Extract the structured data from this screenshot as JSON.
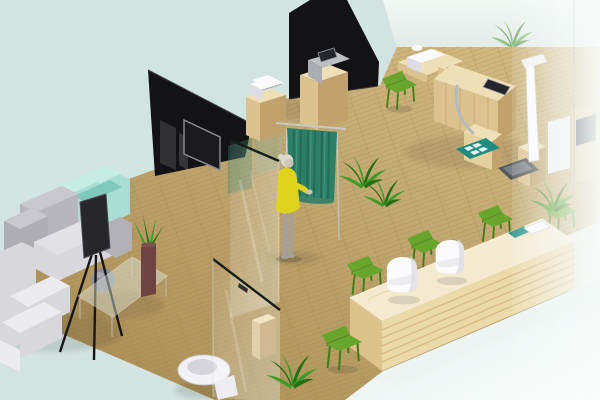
{
  "scene": {
    "type": "isometric-3d-interior-render",
    "setting": "clinic office floor plan 3D rendering",
    "areas": [
      {
        "id": "waiting-area",
        "label": "waiting area with gray corner sofa and mint armchair"
      },
      {
        "id": "consultation-room",
        "label": "consultation room with teal privacy curtain and standing woman"
      },
      {
        "id": "exam-room",
        "label": "exam room with wooden workstation, devices and height scale"
      },
      {
        "id": "reception",
        "label": "reception with long wooden counter and green chairs"
      },
      {
        "id": "restroom",
        "label": "restroom with toilet behind glass partition"
      }
    ],
    "objects": [
      {
        "id": "dark-wall-panel-left",
        "label": "black wall panel with mounted TV"
      },
      {
        "id": "dark-wall-panel-top",
        "label": "black wall panel wedge"
      },
      {
        "id": "privacy-curtain",
        "label": "teal privacy curtain on rail"
      },
      {
        "id": "woman-figure",
        "label": "woman in yellow dress"
      },
      {
        "id": "gray-sofa",
        "label": "gray L-shaped sofa"
      },
      {
        "id": "mint-armchair",
        "label": "mint armchair"
      },
      {
        "id": "tv-tripod",
        "label": "TV display on tripod stand"
      },
      {
        "id": "coffee-table",
        "label": "glass coffee table with plant vase"
      },
      {
        "id": "printer-cabinets",
        "label": "wood cabinets with printer and monitor devices"
      },
      {
        "id": "exam-workstation",
        "label": "wooden exam workstation with embedded screen"
      },
      {
        "id": "height-scale",
        "label": "white height and weight scale"
      },
      {
        "id": "teal-floor-mat",
        "label": "teal floor mat"
      },
      {
        "id": "reception-counter",
        "label": "long light-wood reception counter"
      },
      {
        "id": "green-chairs",
        "label": "apple-green side chairs"
      },
      {
        "id": "white-chairs",
        "label": "white molded chairs"
      },
      {
        "id": "toilet",
        "label": "white toilet"
      },
      {
        "id": "glass-partitions",
        "label": "glass partition walls"
      },
      {
        "id": "frosted-glass-wall",
        "label": "frosted glass wall on the right"
      },
      {
        "id": "potted-plants",
        "label": "green potted plants"
      }
    ]
  },
  "colors": {
    "background": "#d2e4e1",
    "floor_light": "#d4bc86",
    "floor_dark": "#a78a52",
    "floor_line": "#93763f",
    "wall_dark": "#131316",
    "tv_screen": "#1a1a1f",
    "tv_frame": "#8d8d95",
    "glass_edge": "#142019",
    "curtain": "#2c8068",
    "curtain_dark": "#1d5c49",
    "wood": "#dcc28e",
    "wood_top": "#efdfb6",
    "wood_side": "#c2a26c",
    "counter_top": "#f4ead0",
    "counter_front": "#ecd9a8",
    "counter_stripe": "#c79f63",
    "counter_side": "#dcc38c",
    "chair_green": "#68a52d",
    "chair_green_dark": "#3f7d17",
    "sofa_gray": "#b7b6bc",
    "sofa_gray_light": "#d8d7dc",
    "sofa_white": "#ecebf0",
    "armchair_mint": "#a9dfd3",
    "armchair_mint_dark": "#7fc9ba",
    "dress_yellow": "#dfd31e",
    "skin": "#cfc6b8",
    "hair": "#dcd8d0",
    "pants": "#a5a19a",
    "plant": "#3f9b28",
    "plant_dark": "#256e13",
    "vase": "#6f4343",
    "white": "#fbfbfd",
    "white_shade": "#dcdce4",
    "device_gray": "#bcbfc4",
    "screen_dark": "#24262b",
    "chrome": "#b4babd",
    "mat_teal": "#1e8d80",
    "toilet": "#f2f2f6",
    "frost": "#f7fbfa",
    "fade": "#e7f1ee",
    "shadow": "#1c1c1c"
  }
}
